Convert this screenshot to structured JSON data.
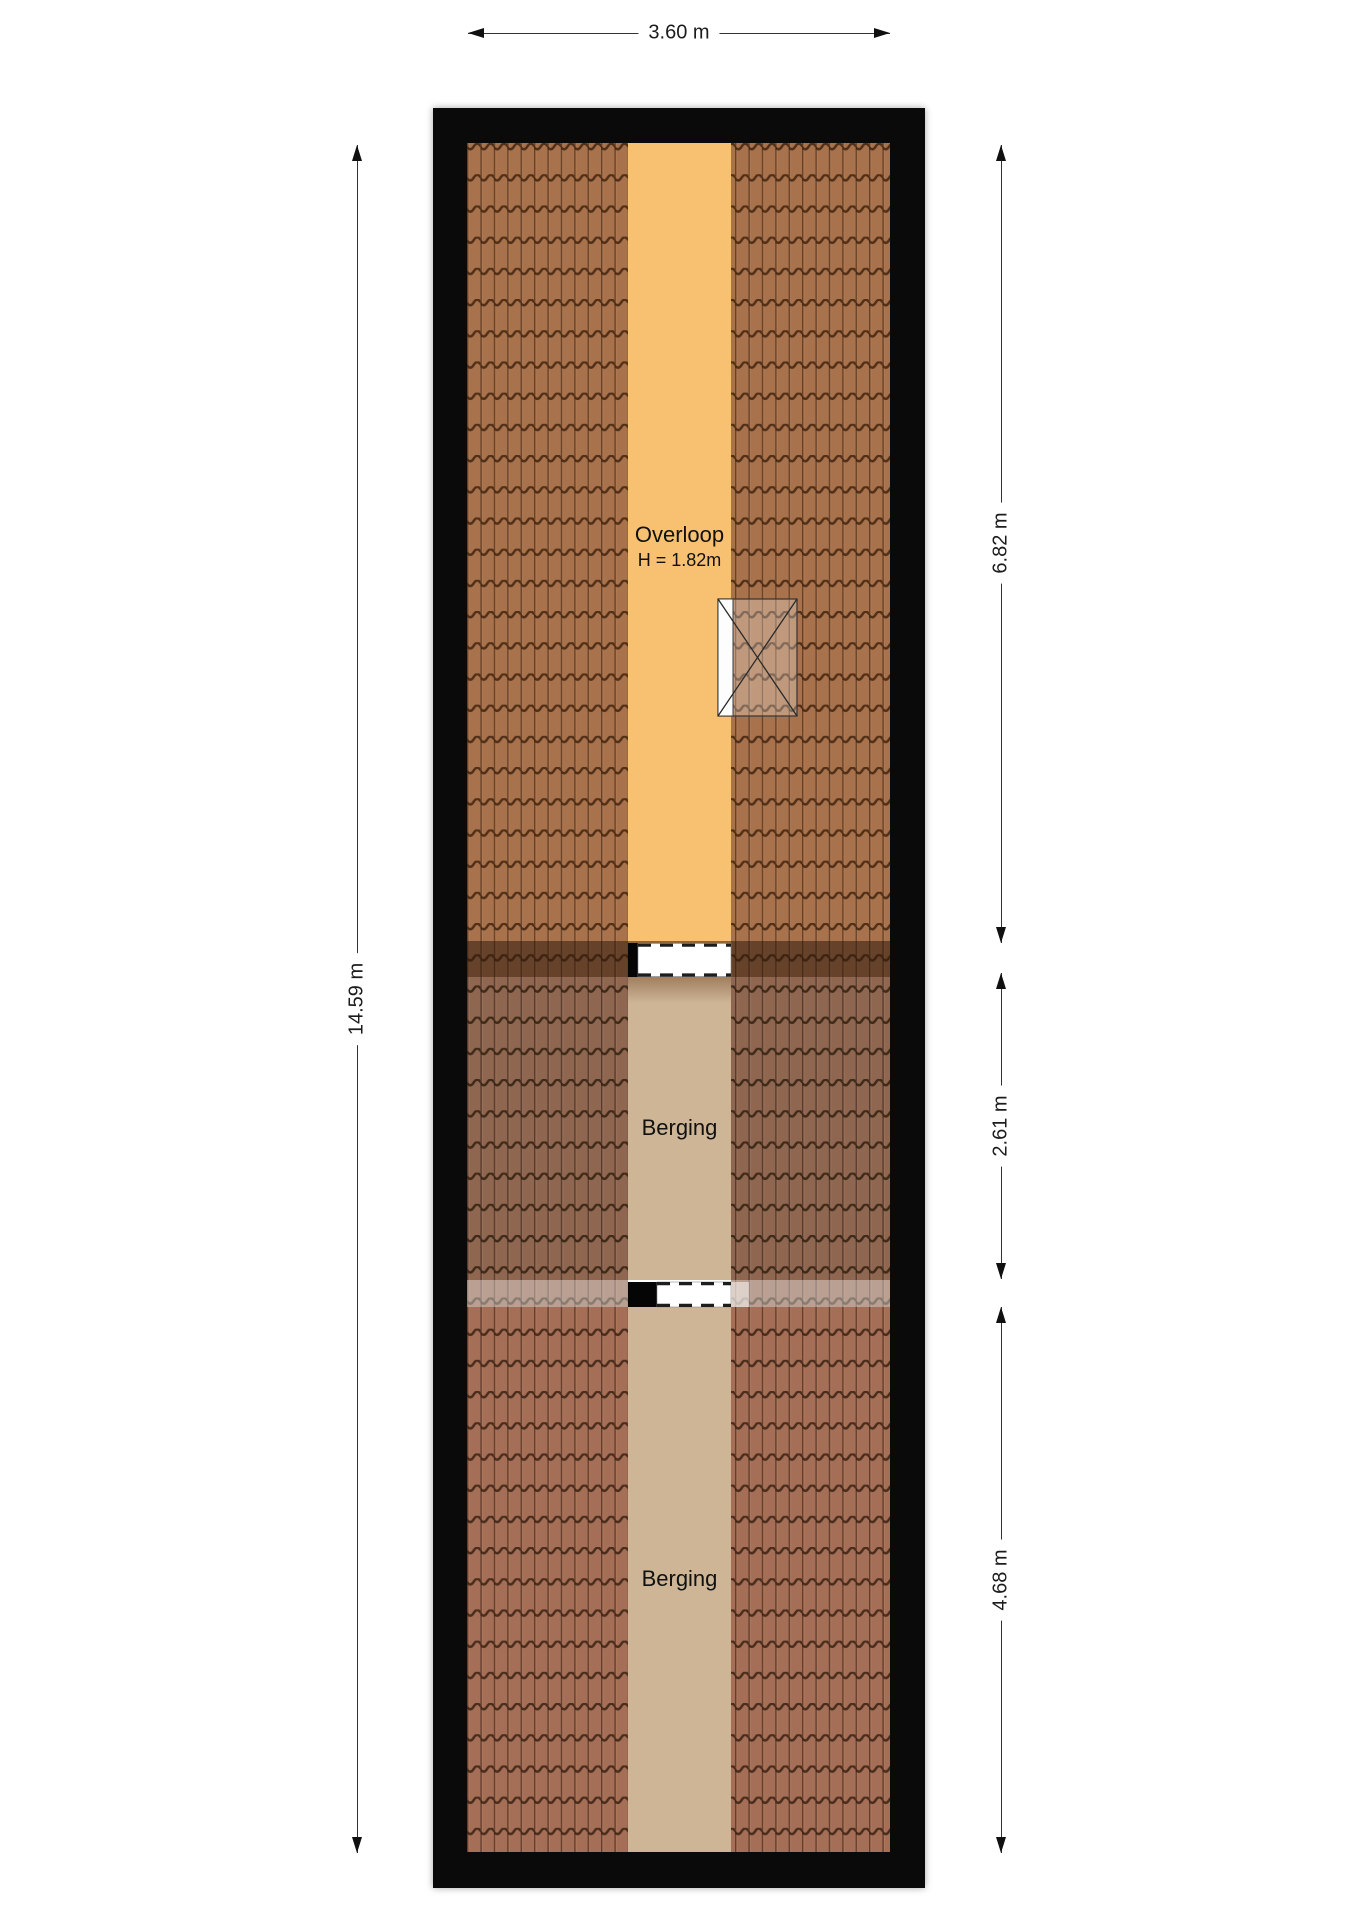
{
  "floorplan": {
    "rooms": {
      "overloop": {
        "label": "Overloop",
        "height_note": "H = 1.82m"
      },
      "berging_middle": {
        "label": "Berging"
      },
      "berging_bottom": {
        "label": "Berging"
      }
    },
    "dimensions": {
      "top_width": "3.60 m",
      "left_height": "14.59 m",
      "right_sections": [
        {
          "label": "6.82 m"
        },
        {
          "label": "2.61 m"
        },
        {
          "label": "4.68 m"
        }
      ]
    },
    "colors": {
      "wall": "#0a0a0a",
      "overloop_floor": "#f8c171",
      "berging_floor": "#cdb596",
      "roof_top": "#a8724c",
      "roof_middle": "#8f6750",
      "roof_bottom": "#a46f56",
      "dimension_text": "#1c1c1c"
    }
  }
}
